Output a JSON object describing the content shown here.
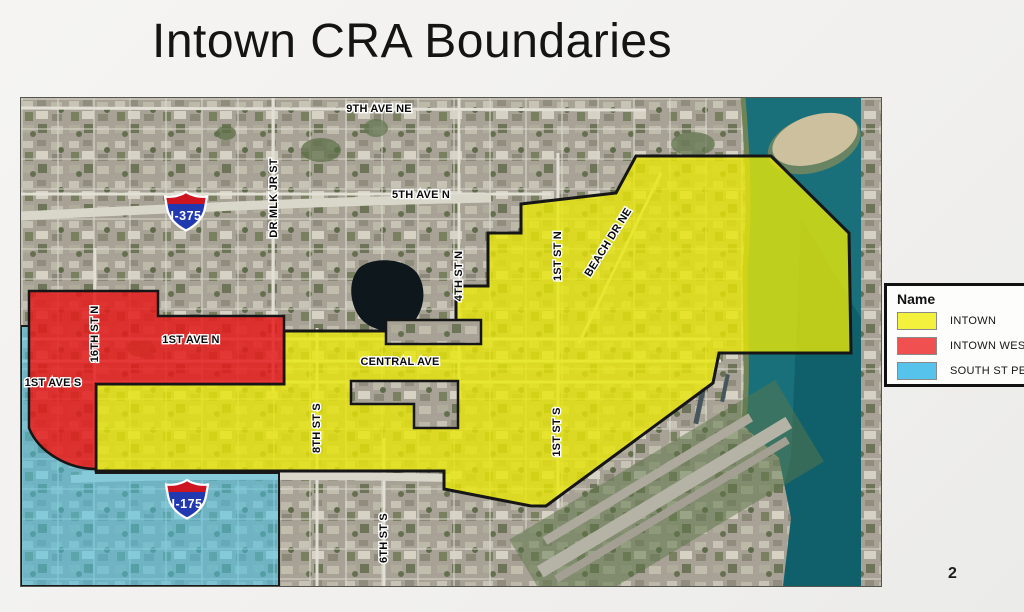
{
  "slide": {
    "title": "Intown CRA Boundaries",
    "page_number": "2"
  },
  "legend": {
    "title": "Name",
    "items": [
      {
        "label": "INTOWN",
        "color": "#f4f13c"
      },
      {
        "label": "INTOWN WEST",
        "color": "#f15050"
      },
      {
        "label": "SOUTH ST PETE",
        "color": "#56c3ec"
      }
    ]
  },
  "map": {
    "regions": {
      "intown": {
        "name": "INTOWN",
        "fill": "#e9e708"
      },
      "intown_west": {
        "name": "INTOWN WEST",
        "fill": "#e41c1c"
      },
      "south_st_pete": {
        "name": "SOUTH ST PETE",
        "fill": "#44c2ea"
      }
    },
    "streets": {
      "ave9": "9TH AVE NE",
      "ave5": "5TH AVE N",
      "mlk": "DR MLK JR ST",
      "st4": "4TH ST N",
      "st1n": "1ST ST N",
      "beach": "BEACH DR NE",
      "st16": "16TH ST N",
      "ave1n": "1ST AVE N",
      "ave1s": "1ST AVE S",
      "central": "CENTRAL AVE",
      "st8": "8TH ST S",
      "st1s": "1ST ST S",
      "st6": "6TH ST S"
    },
    "shields": [
      {
        "label": "I-375"
      },
      {
        "label": "I-175"
      }
    ],
    "colors": {
      "water": "#19707a",
      "water_deep": "#0e5c68",
      "land": "#a7a295",
      "island": "#cdc09e",
      "shield_blue": "#2038b0",
      "shield_red": "#cc1520"
    }
  }
}
